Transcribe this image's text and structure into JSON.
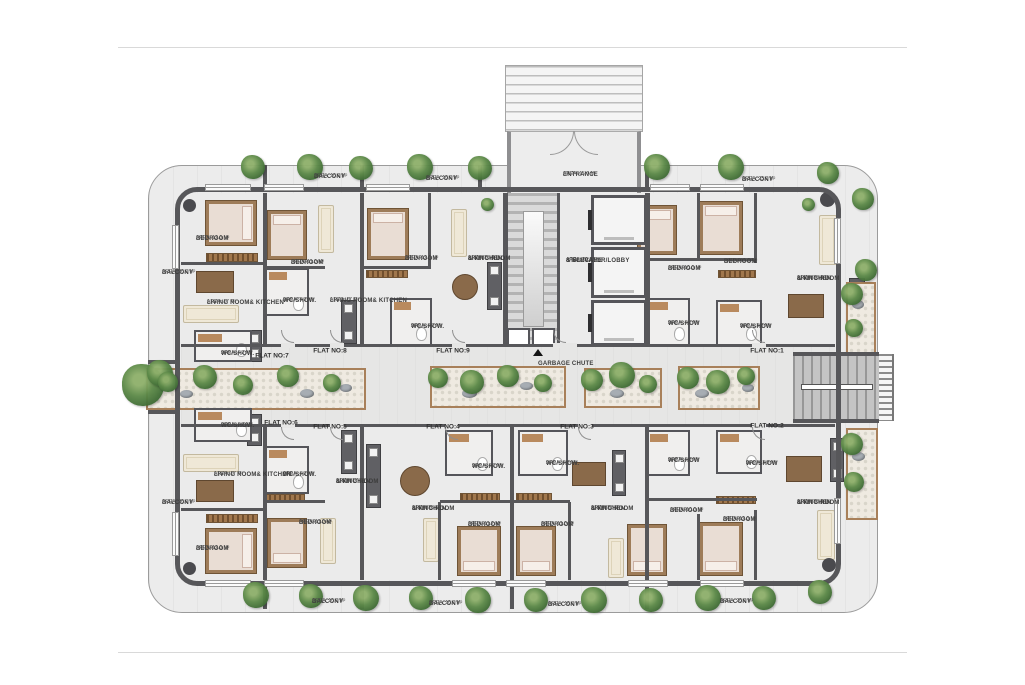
{
  "title": "Residential floor plan",
  "colors": {
    "wall": "#57575a",
    "floor": "#ebebeb",
    "terrace": "#ececec",
    "wood_trim": "#a8805a",
    "greenery": "#5d8a49",
    "stair": "#c4c4c4"
  },
  "icons": {
    "garbage_chute_marker": "triangle-up-icon",
    "tree": "tree-icon"
  },
  "flat_numbers": [
    {
      "id": "flat-7",
      "text": "FLAT NO:7",
      "x": 272,
      "y": 356
    },
    {
      "id": "flat-8",
      "text": "FLAT NO:8",
      "x": 330,
      "y": 351
    },
    {
      "id": "flat-9",
      "text": "FLAT NO:9",
      "x": 453,
      "y": 351
    },
    {
      "id": "flat-1",
      "text": "FLAT NO:1",
      "x": 767,
      "y": 351
    },
    {
      "id": "flat-6",
      "text": "FLAT NO:6",
      "x": 281,
      "y": 423
    },
    {
      "id": "flat-5",
      "text": "FLAT NO:5",
      "x": 330,
      "y": 427
    },
    {
      "id": "flat-4",
      "text": "FLAT NO:4",
      "x": 443,
      "y": 427
    },
    {
      "id": "flat-3",
      "text": "FLAT NO:3",
      "x": 577,
      "y": 427
    },
    {
      "id": "flat-2",
      "text": "FLAT NO:2",
      "x": 767,
      "y": 426
    }
  ],
  "labels": [
    {
      "id": "balcony-top-1",
      "lines": [
        "BALCONY"
      ],
      "area": "AREA: 10.0 M²",
      "x": 314,
      "y": 174
    },
    {
      "id": "balcony-top-2",
      "lines": [
        "BALCONY"
      ],
      "area": "AREA: 10.0 M²",
      "x": 426,
      "y": 176
    },
    {
      "id": "entrance",
      "lines": [
        "ENTRANCE"
      ],
      "area": "AREA: 15.0 M²",
      "x": 563,
      "y": 172
    },
    {
      "id": "balcony-top-3",
      "lines": [
        "BALCONY"
      ],
      "area": "AREA: 23.0 M²",
      "x": 742,
      "y": 177
    },
    {
      "id": "balcony-left-top",
      "lines": [
        "BALCONY"
      ],
      "area": "AREA: 20.0 M²",
      "x": 162,
      "y": 270
    },
    {
      "id": "balcony-left-bottom",
      "lines": [
        "BALCONY"
      ],
      "area": "AREA: 20.0 M²",
      "x": 162,
      "y": 500
    },
    {
      "id": "balcony-bottom-1",
      "lines": [
        "BALCONY"
      ],
      "area": "AREA: 10.0 M²",
      "x": 312,
      "y": 599
    },
    {
      "id": "balcony-bottom-2",
      "lines": [
        "BALCONY"
      ],
      "area": "AREA: 10.0 M²",
      "x": 429,
      "y": 601
    },
    {
      "id": "balcony-bottom-3",
      "lines": [
        "BALCONY"
      ],
      "area": "AREA: 10.0 M²",
      "x": 548,
      "y": 602
    },
    {
      "id": "balcony-bottom-4",
      "lines": [
        "BALCONY"
      ],
      "area": "AREA: 20.0 M²",
      "x": 720,
      "y": 599
    },
    {
      "id": "staircase-lobby",
      "lines": [
        "STAIRCASE",
        "& ELEVATOR/LOBBY"
      ],
      "area": "AREA: 29.7 M²",
      "x": 566,
      "y": 258
    },
    {
      "id": "garbage-chute",
      "lines": [
        "GARBAGE CHUTE"
      ],
      "x": 538,
      "y": 361
    },
    {
      "id": "f7-bedroom",
      "lines": [
        "BEDROOM"
      ],
      "area": "AREA: 12.0 M²",
      "x": 196,
      "y": 236
    },
    {
      "id": "f7-living",
      "lines": [
        "LIVING ROOM& KITCHEN"
      ],
      "area": "AREA: 17 M²",
      "x": 207,
      "y": 300
    },
    {
      "id": "f7-wc",
      "lines": [
        "WC/SHOW."
      ],
      "area": "AREA: 4.3 M²",
      "x": 221,
      "y": 351
    },
    {
      "id": "f8-bedroom",
      "lines": [
        "BEDROOM"
      ],
      "area": "AREA: 11.0 M²",
      "x": 291,
      "y": 260
    },
    {
      "id": "f8-wc",
      "lines": [
        "WC/SHOW."
      ],
      "area": "AREA: 4.3 M²",
      "x": 283,
      "y": 298
    },
    {
      "id": "f8-living",
      "lines": [
        "LIVING ROOM& KITCHEN"
      ],
      "area": "AREA: 17 M²",
      "x": 330,
      "y": 298
    },
    {
      "id": "f9-bedroom",
      "lines": [
        "BEDROOM"
      ],
      "area": "AREA: 12.0 M²",
      "x": 405,
      "y": 256
    },
    {
      "id": "f9-living",
      "lines": [
        "LIVING ROOM",
        "& KITCHEN"
      ],
      "area": "AREA: 20.0 M²",
      "x": 468,
      "y": 256
    },
    {
      "id": "f9-wc",
      "lines": [
        "WC/SHOW."
      ],
      "area": "AREA: 4.3 M²",
      "x": 411,
      "y": 324
    },
    {
      "id": "f1-bedroom-1",
      "lines": [
        "BEDROOM"
      ],
      "area": "AREA: 10.0 M²",
      "x": 668,
      "y": 266
    },
    {
      "id": "f1-bedroom-2",
      "lines": [
        "BEDROOM"
      ],
      "area": "AREA: 12.0 M²",
      "x": 724,
      "y": 259
    },
    {
      "id": "f1-living",
      "lines": [
        "LIVING ROOM",
        "& KITCHEN"
      ],
      "area": "AREA: 30.0 M²",
      "x": 797,
      "y": 276
    },
    {
      "id": "f1-wc-1",
      "lines": [
        "WC/SHOW"
      ],
      "area": "AREA: 4.1 M²",
      "x": 668,
      "y": 321
    },
    {
      "id": "f1-wc-2",
      "lines": [
        "WC/SHOW"
      ],
      "area": "AREA: 3.5 M²",
      "x": 740,
      "y": 324
    },
    {
      "id": "f6-wc",
      "lines": [
        "WC/SHOW."
      ],
      "area": "AREA: 4.3 M²",
      "x": 221,
      "y": 423
    },
    {
      "id": "f6-living",
      "lines": [
        "LIVING ROOM& KITCHEN"
      ],
      "area": "AREA: 17 M²",
      "x": 214,
      "y": 472
    },
    {
      "id": "f6-bedroom",
      "lines": [
        "BEDROOM"
      ],
      "area": "AREA: 12.0 M²",
      "x": 196,
      "y": 546
    },
    {
      "id": "f5-wc",
      "lines": [
        "WC/SHOW."
      ],
      "area": "AREA: 4.3 M²",
      "x": 283,
      "y": 472
    },
    {
      "id": "f5-living",
      "lines": [
        "LIVING ROOM",
        "& KITCHEN"
      ],
      "area": "AREA: 17 M²",
      "x": 336,
      "y": 479
    },
    {
      "id": "f5-bedroom",
      "lines": [
        "BEDROOM"
      ],
      "area": "AREA: 11.0 M²",
      "x": 299,
      "y": 520
    },
    {
      "id": "f4-wc",
      "lines": [
        "WC/SHOW."
      ],
      "area": "AREA: 4.1 M²",
      "x": 472,
      "y": 464
    },
    {
      "id": "f4-living",
      "lines": [
        "LIVING ROOM",
        "& KITCHEN"
      ],
      "area": "AREA: 25 M²",
      "x": 412,
      "y": 506
    },
    {
      "id": "f4-bedroom",
      "lines": [
        "BEDROOM"
      ],
      "area": "AREA: 11.2 M²",
      "x": 468,
      "y": 522
    },
    {
      "id": "f3-wc",
      "lines": [
        "WC/SHOW."
      ],
      "area": "AREA: 4.0 M²",
      "x": 546,
      "y": 461
    },
    {
      "id": "f3-living",
      "lines": [
        "LIVING ROOM",
        "& KITCHEN"
      ],
      "area": "AREA: 22 M²",
      "x": 591,
      "y": 506
    },
    {
      "id": "f3-bedroom",
      "lines": [
        "BEDROOM"
      ],
      "area": "AREA: 11.0 M²",
      "x": 541,
      "y": 522
    },
    {
      "id": "f2-wc-1",
      "lines": [
        "WC/SHOW"
      ],
      "area": "AREA: 4.0 M²",
      "x": 668,
      "y": 458
    },
    {
      "id": "f2-bedroom-1",
      "lines": [
        "BEDROOM"
      ],
      "area": "AREA: 10.0 M²",
      "x": 670,
      "y": 508
    },
    {
      "id": "f2-wc-2",
      "lines": [
        "WC/SHOW"
      ],
      "area": "AREA: 3.5 M²",
      "x": 746,
      "y": 461
    },
    {
      "id": "f2-bedroom-2",
      "lines": [
        "BEDROOM"
      ],
      "area": "AREA: 12.0 M²",
      "x": 723,
      "y": 517
    },
    {
      "id": "f2-living",
      "lines": [
        "LIVING ROOM",
        "& KITCHEN"
      ],
      "area": "AREA: 30.0 M²",
      "x": 797,
      "y": 500
    }
  ],
  "landscape": {
    "trees": [
      {
        "x": 253,
        "y": 167,
        "s": 24
      },
      {
        "x": 310,
        "y": 167,
        "s": 26
      },
      {
        "x": 361,
        "y": 168,
        "s": 24
      },
      {
        "x": 420,
        "y": 167,
        "s": 26
      },
      {
        "x": 480,
        "y": 168,
        "s": 24
      },
      {
        "x": 657,
        "y": 167,
        "s": 26
      },
      {
        "x": 731,
        "y": 167,
        "s": 26
      },
      {
        "x": 828,
        "y": 173,
        "s": 22
      },
      {
        "x": 863,
        "y": 199,
        "s": 22
      },
      {
        "x": 256,
        "y": 595,
        "s": 26
      },
      {
        "x": 311,
        "y": 596,
        "s": 24
      },
      {
        "x": 366,
        "y": 598,
        "s": 26
      },
      {
        "x": 421,
        "y": 598,
        "s": 24
      },
      {
        "x": 478,
        "y": 600,
        "s": 26
      },
      {
        "x": 536,
        "y": 600,
        "s": 24
      },
      {
        "x": 594,
        "y": 600,
        "s": 26
      },
      {
        "x": 651,
        "y": 600,
        "s": 24
      },
      {
        "x": 708,
        "y": 598,
        "s": 26
      },
      {
        "x": 764,
        "y": 598,
        "s": 24
      },
      {
        "x": 820,
        "y": 592,
        "s": 24
      },
      {
        "x": 143,
        "y": 385,
        "s": 42
      },
      {
        "x": 160,
        "y": 373,
        "s": 26
      },
      {
        "x": 866,
        "y": 270,
        "s": 22
      },
      {
        "x": 168,
        "y": 382,
        "s": 20
      },
      {
        "x": 205,
        "y": 377,
        "s": 24
      },
      {
        "x": 243,
        "y": 385,
        "s": 20
      },
      {
        "x": 288,
        "y": 376,
        "s": 22
      },
      {
        "x": 332,
        "y": 383,
        "s": 18
      },
      {
        "x": 438,
        "y": 378,
        "s": 20
      },
      {
        "x": 472,
        "y": 382,
        "s": 24
      },
      {
        "x": 508,
        "y": 376,
        "s": 22
      },
      {
        "x": 543,
        "y": 383,
        "s": 18
      },
      {
        "x": 592,
        "y": 380,
        "s": 22
      },
      {
        "x": 622,
        "y": 375,
        "s": 26
      },
      {
        "x": 648,
        "y": 384,
        "s": 18
      },
      {
        "x": 688,
        "y": 378,
        "s": 22
      },
      {
        "x": 718,
        "y": 382,
        "s": 24
      },
      {
        "x": 746,
        "y": 376,
        "s": 18
      },
      {
        "x": 852,
        "y": 294,
        "s": 22
      },
      {
        "x": 854,
        "y": 328,
        "s": 18
      },
      {
        "x": 852,
        "y": 444,
        "s": 22
      },
      {
        "x": 854,
        "y": 482,
        "s": 20
      },
      {
        "x": 487,
        "y": 204,
        "s": 13
      },
      {
        "x": 808,
        "y": 204,
        "s": 13
      }
    ]
  }
}
